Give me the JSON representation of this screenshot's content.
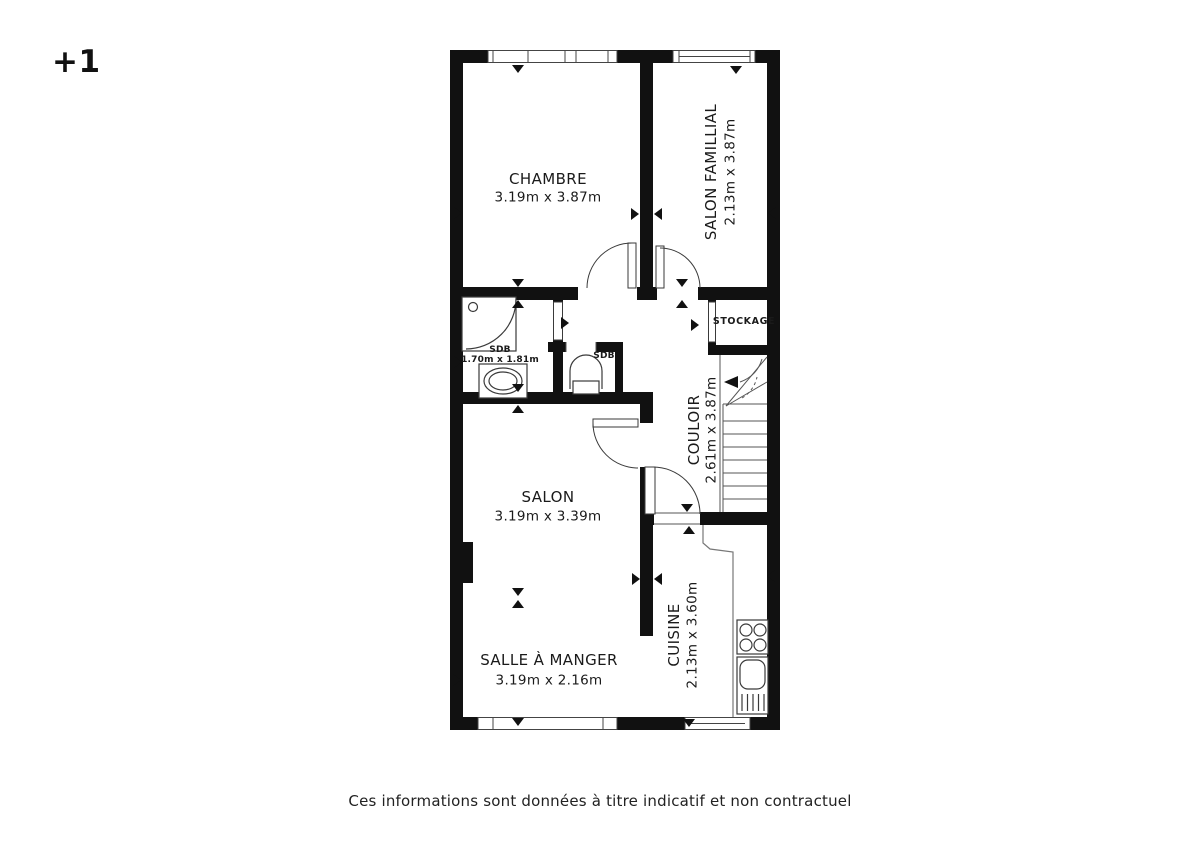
{
  "floor_label": "+1",
  "disclaimer": "Ces informations sont données à titre indicatif et non contractuel",
  "rooms": [
    {
      "id": "chambre",
      "name": "CHAMBRE",
      "dimensions": "3.19m x 3.87m"
    },
    {
      "id": "salon-famillial",
      "name": "SALON FAMILLIAL",
      "dimensions": "2.13m x 3.87m"
    },
    {
      "id": "sdb-1",
      "name": "SDB",
      "dimensions": "1.70m x 1.81m"
    },
    {
      "id": "sdb-2",
      "name": "SDB",
      "dimensions": ""
    },
    {
      "id": "stockage",
      "name": "STOCKAGE",
      "dimensions": ""
    },
    {
      "id": "couloir",
      "name": "COULOIR",
      "dimensions": "2.61m x 3.87m"
    },
    {
      "id": "salon",
      "name": "SALON",
      "dimensions": "3.19m x 3.39m"
    },
    {
      "id": "salle-a-manger",
      "name": "SALLE À MANGER",
      "dimensions": "3.19m x 2.16m"
    },
    {
      "id": "cuisine",
      "name": "CUISINE",
      "dimensions": "2.13m x 3.60m"
    }
  ],
  "colors": {
    "wall": "#111111",
    "fixture_line": "#3a3a3a",
    "thin_line": "#666666",
    "background": "#ffffff"
  }
}
